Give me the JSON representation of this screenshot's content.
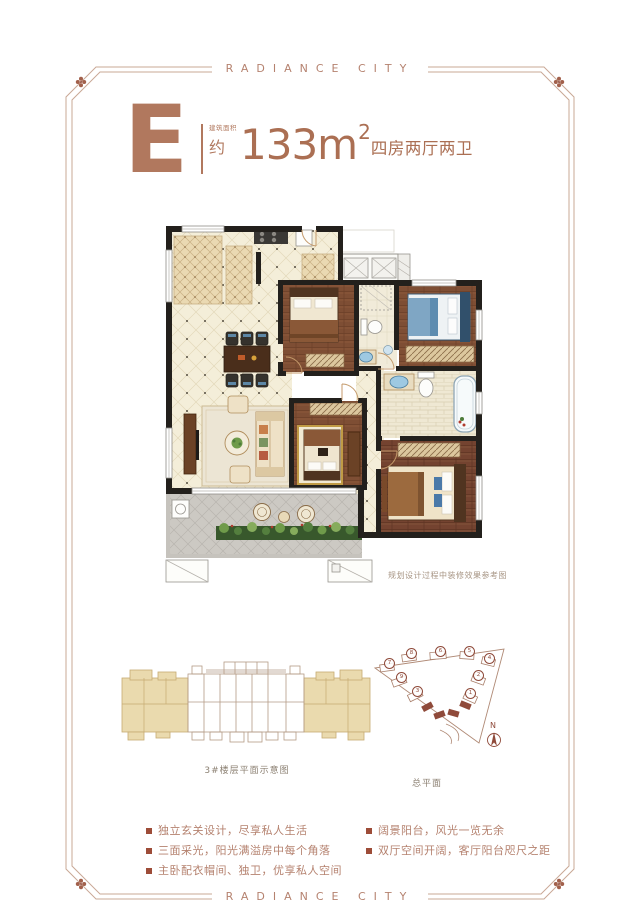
{
  "brand": {
    "top": "RADIANCE CITY",
    "bottom": "RADIANCE CITY"
  },
  "title": {
    "unit": "E",
    "area_note": "建筑面积",
    "area_prefix": "约",
    "area_value_with_unit": "133m",
    "area_exponent": "2",
    "layout": "四房两厅两卫"
  },
  "floorplan": {
    "caption": "规划设计过程中装修效果参考图"
  },
  "diagrams": {
    "floor_schematic_caption": "3#楼层平面示意图",
    "site_plan_caption": "总平面",
    "north_label": "N",
    "site_building_labels": [
      "7",
      "8",
      "6",
      "5",
      "4",
      "9",
      "3",
      "2",
      "1"
    ]
  },
  "features": {
    "left": [
      "独立玄关设计，尽享私人生活",
      "三面采光，阳光满溢房中每个角落",
      "主卧配衣帽间、独卫，优享私人空间"
    ],
    "right": [
      "阔景阳台，风光一览无余",
      "双厅空间开阔，客厅阳台咫尺之距"
    ]
  },
  "colors": {
    "accent": "#b1785e",
    "frame": "#c9a896",
    "bullet": "#9d4c38",
    "highlight": "#8f4a3a"
  }
}
